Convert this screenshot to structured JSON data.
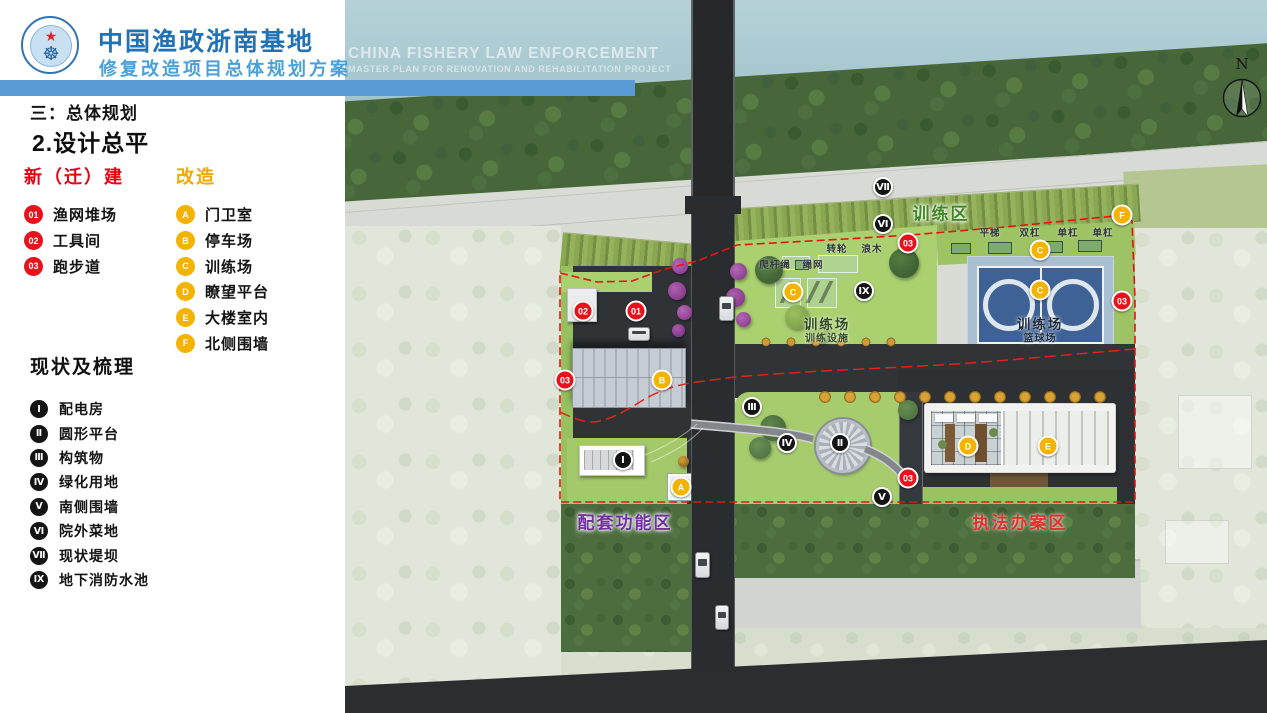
{
  "header": {
    "title": "中国渔政浙南基地",
    "subtitle": "修复改造项目总体规划方案",
    "en1": "CHINA FISHERY LAW ENFORCEMENT",
    "en2": "MASTER PLAN FOR RENOVATION AND REHABILITATION PROJECT",
    "logo": {
      "star_icon": "★",
      "wheel_icon": "☸"
    }
  },
  "sidebar": {
    "section_no": "三：总体规划",
    "section_title": "2.设计总平",
    "legend_new": {
      "title": "新（迁）建",
      "color": "#e60012",
      "items": [
        {
          "badge": "01",
          "label": "渔网堆场"
        },
        {
          "badge": "02",
          "label": "工具间"
        },
        {
          "badge": "03",
          "label": "跑步道"
        }
      ]
    },
    "legend_reno": {
      "title": "改造",
      "color": "#f2a900",
      "items": [
        {
          "badge": "A",
          "label": "门卫室"
        },
        {
          "badge": "B",
          "label": "停车场"
        },
        {
          "badge": "C",
          "label": "训练场"
        },
        {
          "badge": "D",
          "label": "瞭望平台"
        },
        {
          "badge": "E",
          "label": "大楼室内"
        },
        {
          "badge": "F",
          "label": "北侧围墙"
        }
      ]
    },
    "legend_status": {
      "title": "现状及梳理",
      "items": [
        {
          "badge": "Ⅰ",
          "label": "配电房"
        },
        {
          "badge": "Ⅱ",
          "label": "圆形平台"
        },
        {
          "badge": "Ⅲ",
          "label": "构筑物"
        },
        {
          "badge": "Ⅳ",
          "label": "绿化用地"
        },
        {
          "badge": "Ⅴ",
          "label": "南侧围墙"
        },
        {
          "badge": "Ⅵ",
          "label": "院外菜地"
        },
        {
          "badge": "Ⅶ",
          "label": "现状堤坝"
        },
        {
          "badge": "Ⅸ",
          "label": "地下消防水池"
        }
      ]
    }
  },
  "map": {
    "compass_label": "N",
    "colors": {
      "boundary_red": "#ea1212",
      "court_blue": "#3e6196",
      "accent_blue_bar": "#5b9bd5"
    },
    "zone_labels": [
      {
        "text": "训练区",
        "x": 596,
        "y": 212,
        "cls": "zl-green"
      },
      {
        "text": "配套功能区",
        "x": 280,
        "y": 521,
        "cls": "zl-purple"
      },
      {
        "text": "执法办案区",
        "x": 675,
        "y": 521,
        "cls": "zl-red"
      }
    ],
    "area_labels": [
      {
        "text": "训练场",
        "x": 482,
        "y": 323,
        "cls": "al-main al-green"
      },
      {
        "text": "训练设施",
        "x": 482,
        "y": 337,
        "cls": "al-sub al-green"
      },
      {
        "text": "训练场",
        "x": 695,
        "y": 323,
        "cls": "al-main al-navy"
      },
      {
        "text": "篮球场",
        "x": 695,
        "y": 337,
        "cls": "al-sub al-navy"
      }
    ],
    "equipment_labels": [
      {
        "text": "平梯",
        "x": 645,
        "y": 232
      },
      {
        "text": "双杠",
        "x": 685,
        "y": 232
      },
      {
        "text": "单杠",
        "x": 723,
        "y": 232
      },
      {
        "text": "单杠",
        "x": 758,
        "y": 232
      },
      {
        "text": "转轮",
        "x": 492,
        "y": 248
      },
      {
        "text": "浪木",
        "x": 527,
        "y": 248
      },
      {
        "text": "爬杆绳",
        "x": 430,
        "y": 264
      },
      {
        "text": "绳网",
        "x": 468,
        "y": 264
      }
    ],
    "badges": [
      {
        "type": "red",
        "label": "02",
        "x": 238,
        "y": 311
      },
      {
        "type": "red",
        "label": "01",
        "x": 291,
        "y": 311
      },
      {
        "type": "red",
        "label": "03",
        "x": 220,
        "y": 380
      },
      {
        "type": "red",
        "label": "03",
        "x": 563,
        "y": 243
      },
      {
        "type": "red",
        "label": "03",
        "x": 777,
        "y": 301
      },
      {
        "type": "red",
        "label": "03",
        "x": 563,
        "y": 478
      },
      {
        "type": "yellow",
        "label": "A",
        "x": 336,
        "y": 487
      },
      {
        "type": "yellow",
        "label": "B",
        "x": 317,
        "y": 380
      },
      {
        "type": "yellow",
        "label": "C",
        "x": 448,
        "y": 292
      },
      {
        "type": "yellow",
        "label": "C",
        "x": 695,
        "y": 250
      },
      {
        "type": "yellow",
        "label": "C",
        "x": 695,
        "y": 290
      },
      {
        "type": "yellow",
        "label": "D",
        "x": 623,
        "y": 446
      },
      {
        "type": "yellow",
        "label": "E",
        "x": 703,
        "y": 446
      },
      {
        "type": "yellow",
        "label": "F",
        "x": 777,
        "y": 215
      },
      {
        "type": "black",
        "label": "Ⅶ",
        "x": 538,
        "y": 187
      },
      {
        "type": "black",
        "label": "Ⅵ",
        "x": 538,
        "y": 224
      },
      {
        "type": "black",
        "label": "Ⅸ",
        "x": 519,
        "y": 291
      },
      {
        "type": "black",
        "label": "Ⅲ",
        "x": 407,
        "y": 407
      },
      {
        "type": "black",
        "label": "Ⅳ",
        "x": 442,
        "y": 443
      },
      {
        "type": "black",
        "label": "Ⅱ",
        "x": 495,
        "y": 443
      },
      {
        "type": "black",
        "label": "Ⅴ",
        "x": 537,
        "y": 497
      },
      {
        "type": "black",
        "label": "Ⅰ",
        "x": 278,
        "y": 460
      }
    ]
  }
}
